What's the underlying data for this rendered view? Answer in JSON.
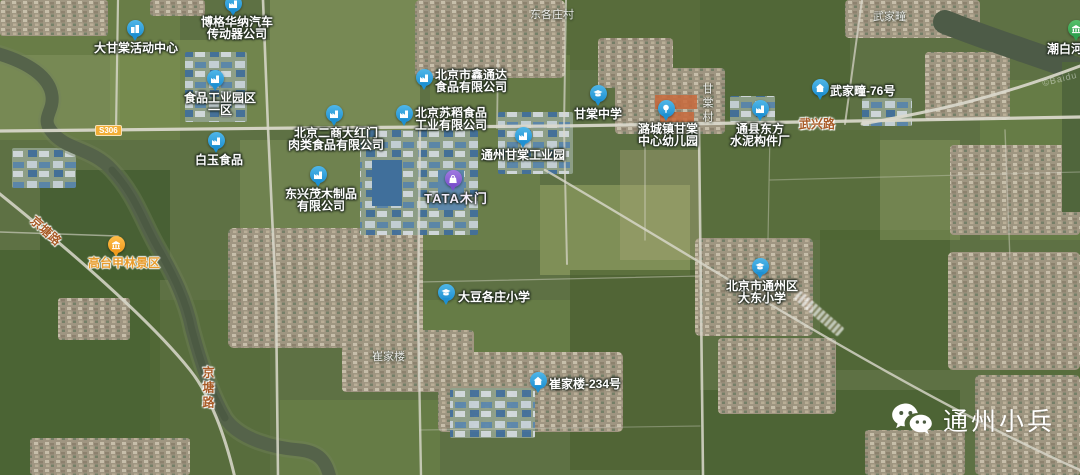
{
  "watermark": {
    "text": "通州小兵"
  },
  "colors": {
    "pin_blue": "#1e90d2",
    "pin_blue_light": "#4fb6e8",
    "pin_purple": "#7a50cc",
    "pin_purple_light": "#a07ae0",
    "pin_orange": "#f09a1c",
    "pin_orange_light": "#ffbd4a",
    "pin_green": "#2fa14f",
    "pin_green_light": "#55c06a",
    "road_label": "#a85a26",
    "poi_label": "#ffffff",
    "badge_bg": "#f2ae35"
  },
  "map": {
    "attribution": "©Baidu",
    "road_badges": [
      {
        "text": "S306",
        "x": 95,
        "y": 125
      },
      {
        "text": "",
        "x": -13,
        "y": 125
      }
    ],
    "road_labels": [
      {
        "text": "京塘路",
        "x": 28,
        "y": 222,
        "rotate": 42,
        "vertical": false
      },
      {
        "text": "京塘路",
        "x": 200,
        "y": 366,
        "rotate": 0,
        "vertical": true
      },
      {
        "text": "武兴路",
        "x": 799,
        "y": 115,
        "rotate": 0,
        "vertical": false
      }
    ],
    "village_labels": [
      {
        "text": "东各庄村",
        "x": 530,
        "y": 6,
        "vertical": false
      },
      {
        "text": "武家疃",
        "x": 873,
        "y": 8,
        "vertical": false
      },
      {
        "text": "甘棠村",
        "x": 699,
        "y": 83,
        "vertical": true
      },
      {
        "text": "崔家楼",
        "x": 372,
        "y": 348,
        "vertical": false
      }
    ],
    "pois": [
      {
        "name": "bogehuana-auto",
        "icon": "factory",
        "color": "blue",
        "x": 233,
        "y": 16,
        "lines": [
          "博格华纳汽车",
          "传动器公司"
        ],
        "label": {
          "dx": 4,
          "dy": 1,
          "align": "center"
        }
      },
      {
        "name": "dagantang-activity-center",
        "icon": "building",
        "color": "blue",
        "x": 135,
        "y": 41,
        "lines": [
          "大甘棠活动中心"
        ],
        "label": {
          "dx": 1,
          "dy": 2,
          "align": "center"
        }
      },
      {
        "name": "food-industrial-park-1",
        "icon": "factory",
        "color": "blue",
        "x": 215,
        "y": 91,
        "lines": [
          "食品工业园区",
          "一区"
        ],
        "label": {
          "dx": 5,
          "dy": 2,
          "align": "center"
        }
      },
      {
        "name": "xintongda-food",
        "icon": "factory",
        "color": "blue",
        "x": 424,
        "y": 90,
        "lines": [
          "北京市鑫通达",
          "食品有限公司"
        ],
        "label": {
          "dx": 11,
          "dy": -20,
          "align": "left"
        }
      },
      {
        "name": "sudao-food",
        "icon": "factory",
        "color": "blue",
        "x": 404,
        "y": 126,
        "lines": [
          "北京苏稻食品",
          "工业有限公司"
        ],
        "label": {
          "dx": 11,
          "dy": -18,
          "align": "left"
        }
      },
      {
        "name": "ershang-dahongmen",
        "icon": "factory",
        "color": "blue",
        "x": 334,
        "y": 126,
        "lines": [
          "北京二商大红门",
          "肉类食品有限公司"
        ],
        "label": {
          "dx": 2,
          "dy": 2,
          "align": "center"
        }
      },
      {
        "name": "baiyu-food",
        "icon": "factory",
        "color": "blue",
        "x": 216,
        "y": 153,
        "lines": [
          "白玉食品"
        ],
        "label": {
          "dx": 3,
          "dy": 2,
          "align": "center"
        }
      },
      {
        "name": "dongxingmao-wood",
        "icon": "factory",
        "color": "blue",
        "x": 318,
        "y": 187,
        "lines": [
          "东兴茂木制品",
          "有限公司"
        ],
        "label": {
          "dx": 3,
          "dy": 2,
          "align": "center"
        }
      },
      {
        "name": "tongzhou-gantang-industrial-park",
        "icon": "factory",
        "color": "blue",
        "x": 523,
        "y": 148,
        "lines": [
          "通州甘棠工业园"
        ],
        "label": {
          "dx": 0,
          "dy": 2,
          "align": "center"
        }
      },
      {
        "name": "tata-doors",
        "icon": "bag",
        "color": "purple",
        "x": 453,
        "y": 191,
        "lines": [
          "TATA木门"
        ],
        "label": {
          "dx": 3,
          "dy": 2,
          "align": "center",
          "style": "tata"
        }
      },
      {
        "name": "gantang-middle-school",
        "icon": "school",
        "color": "blue",
        "x": 598,
        "y": 106,
        "lines": [
          "甘棠中学"
        ],
        "label": {
          "dx": 0,
          "dy": 3,
          "align": "center"
        }
      },
      {
        "name": "lucheng-gantang-kindergarten",
        "icon": "tree",
        "color": "blue",
        "x": 666,
        "y": 121,
        "lines": [
          "潞城镇甘棠",
          "中心幼儿园"
        ],
        "label": {
          "dx": 2,
          "dy": 3,
          "align": "center"
        }
      },
      {
        "name": "tongxian-dongfang-cement",
        "icon": "factory",
        "color": "blue",
        "x": 760,
        "y": 121,
        "lines": [
          "通县东方",
          "水泥构件厂"
        ],
        "label": {
          "dx": 0,
          "dy": 3,
          "align": "center"
        }
      },
      {
        "name": "wujiatuan-76",
        "icon": "house",
        "color": "blue",
        "x": 820,
        "y": 100,
        "lines": [
          "武家疃-76号"
        ],
        "label": {
          "dx": 10,
          "dy": -14,
          "align": "left"
        }
      },
      {
        "name": "dadougezhuang-primary-school",
        "icon": "school",
        "color": "blue",
        "x": 446,
        "y": 305,
        "lines": [
          "大豆各庄小学"
        ],
        "label": {
          "dx": 12,
          "dy": -13,
          "align": "left"
        }
      },
      {
        "name": "dadong-primary-school",
        "icon": "school",
        "color": "blue",
        "x": 760,
        "y": 279,
        "lines": [
          "北京市通州区",
          "大东小学"
        ],
        "label": {
          "dx": 2,
          "dy": 2,
          "align": "center"
        }
      },
      {
        "name": "cuijialou-234",
        "icon": "house",
        "color": "blue",
        "x": 538,
        "y": 393,
        "lines": [
          "崔家楼-234号"
        ],
        "label": {
          "dx": 11,
          "dy": -14,
          "align": "left"
        }
      },
      {
        "name": "gaotaijialin-scenic-area",
        "icon": "landmark",
        "color": "orange",
        "x": 116,
        "y": 257,
        "lines": [
          "高台甲林景区"
        ],
        "label": {
          "dx": 8,
          "dy": 1,
          "align": "center",
          "style": "scenic"
        }
      },
      {
        "name": "chaobaihe-wetland",
        "icon": "landmark",
        "color": "green",
        "x": 1076,
        "y": 41,
        "lines": [
          "潮白河湿"
        ],
        "label": {
          "dx": -29,
          "dy": 3,
          "align": "left"
        }
      }
    ]
  }
}
